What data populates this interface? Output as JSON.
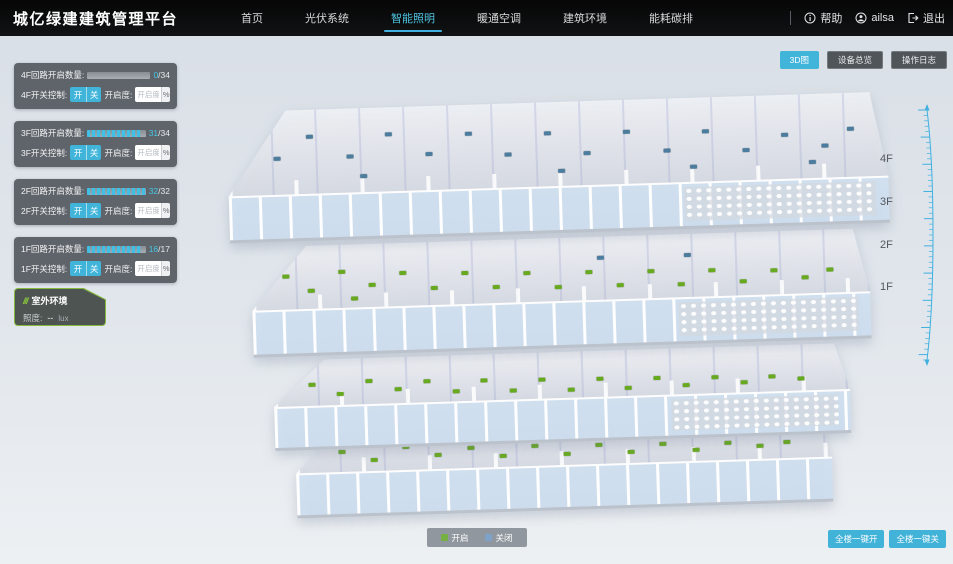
{
  "nav": {
    "title": "城亿绿建建筑管理平台",
    "items": [
      {
        "label": "首页"
      },
      {
        "label": "光伏系统"
      },
      {
        "label": "智能照明"
      },
      {
        "label": "暖通空调"
      },
      {
        "label": "建筑环境"
      },
      {
        "label": "能耗碳排"
      }
    ],
    "help": "帮助",
    "user": "ailsa",
    "logout": "退出"
  },
  "view_buttons": [
    {
      "label": "3D图"
    },
    {
      "label": "设备总览"
    },
    {
      "label": "操作日志"
    }
  ],
  "floor_panels": [
    {
      "count_label": "4F回路开启数量:",
      "open": 0,
      "total": 34,
      "value_open": "0",
      "value_rest": "/34",
      "switch_label": "4F开关控制:",
      "btn_on": "开",
      "btn_off": "关",
      "dim_label": "开启度:",
      "dim_placeholder": "开启度",
      "percent_label": "%"
    },
    {
      "count_label": "3F回路开启数量:",
      "open": 31,
      "total": 34,
      "value_open": "31",
      "value_rest": "/34",
      "switch_label": "3F开关控制:",
      "btn_on": "开",
      "btn_off": "关",
      "dim_label": "开启度:",
      "dim_placeholder": "开启度",
      "percent_label": "%"
    },
    {
      "count_label": "2F回路开启数量:",
      "open": 32,
      "total": 32,
      "value_open": "32",
      "value_rest": "/32",
      "switch_label": "2F开关控制:",
      "btn_on": "开",
      "btn_off": "关",
      "dim_label": "开启度:",
      "dim_placeholder": "开启度",
      "percent_label": "%"
    },
    {
      "count_label": "1F回路开启数量:",
      "open": 16,
      "total": 17,
      "value_open": "16",
      "value_rest": "/17",
      "switch_label": "1F开关控制:",
      "btn_on": "开",
      "btn_off": "关",
      "dim_label": "开启度:",
      "dim_placeholder": "开启度",
      "percent_label": "%"
    }
  ],
  "outdoor": {
    "title": "室外环境",
    "metric_label": "照度:",
    "metric_value": "--",
    "metric_unit": "lux"
  },
  "floor_labels": [
    "4F",
    "3F",
    "2F",
    "1F"
  ],
  "legend": {
    "on_label": "开启",
    "off_label": "关闭",
    "on_color": "#76b043",
    "off_color": "#7fa3c8"
  },
  "bulk_buttons": [
    {
      "label": "全楼一键开"
    },
    {
      "label": "全楼一键关"
    }
  ],
  "colors": {
    "accent": "#41b4da",
    "background": "#dde3e9",
    "panel": "#54595e",
    "dot_on": "#68aa1f",
    "dot_off": "#4d7d9e"
  },
  "building": {
    "floors": [
      {
        "id": "4F",
        "dots": [
          [
            7,
            55,
            0
          ],
          [
            12,
            30,
            0
          ],
          [
            18,
            55,
            0
          ],
          [
            24,
            30,
            0
          ],
          [
            30,
            55,
            0
          ],
          [
            36,
            32,
            0
          ],
          [
            42,
            58,
            0
          ],
          [
            48,
            34,
            0
          ],
          [
            54,
            60,
            0
          ],
          [
            60,
            36,
            0
          ],
          [
            66,
            60,
            0
          ],
          [
            72,
            38,
            0
          ],
          [
            78,
            62,
            0
          ],
          [
            84,
            45,
            0
          ],
          [
            90,
            60,
            0
          ],
          [
            94,
            40,
            0
          ],
          [
            20,
            78,
            0
          ],
          [
            50,
            80,
            0
          ],
          [
            70,
            80,
            0
          ],
          [
            88,
            78,
            0
          ]
        ]
      },
      {
        "id": "3F",
        "dots": [
          [
            5,
            45,
            1
          ],
          [
            9,
            68,
            1
          ],
          [
            14,
            40,
            1
          ],
          [
            19,
            62,
            1
          ],
          [
            24,
            45,
            1
          ],
          [
            29,
            70,
            1
          ],
          [
            34,
            48,
            1
          ],
          [
            39,
            72,
            1
          ],
          [
            44,
            50,
            1
          ],
          [
            49,
            74,
            1
          ],
          [
            54,
            52,
            1
          ],
          [
            59,
            75,
            1
          ],
          [
            64,
            54,
            1
          ],
          [
            69,
            76,
            1
          ],
          [
            74,
            56,
            1
          ],
          [
            79,
            74,
            1
          ],
          [
            84,
            58,
            1
          ],
          [
            89,
            72,
            1
          ],
          [
            93,
            60,
            1
          ],
          [
            16,
            82,
            1
          ],
          [
            56,
            30,
            0
          ],
          [
            70,
            30,
            0
          ]
        ]
      },
      {
        "id": "2F",
        "dots": [
          [
            6,
            50,
            1
          ],
          [
            11,
            72,
            1
          ],
          [
            16,
            45,
            1
          ],
          [
            21,
            66,
            1
          ],
          [
            26,
            50,
            1
          ],
          [
            31,
            74,
            1
          ],
          [
            36,
            52,
            1
          ],
          [
            41,
            76,
            1
          ],
          [
            46,
            54,
            1
          ],
          [
            51,
            78,
            1
          ],
          [
            56,
            56,
            1
          ],
          [
            61,
            78,
            1
          ],
          [
            66,
            58,
            1
          ],
          [
            71,
            76,
            1
          ],
          [
            76,
            60,
            1
          ],
          [
            81,
            74,
            1
          ],
          [
            86,
            62,
            1
          ],
          [
            91,
            70,
            1
          ]
        ]
      },
      {
        "id": "1F",
        "dots": [
          [
            8,
            50,
            1
          ],
          [
            14,
            70,
            1
          ],
          [
            20,
            45,
            1
          ],
          [
            26,
            65,
            1
          ],
          [
            32,
            50,
            1
          ],
          [
            38,
            70,
            1
          ],
          [
            44,
            52,
            1
          ],
          [
            50,
            72,
            1
          ],
          [
            56,
            54,
            1
          ],
          [
            62,
            72,
            1
          ],
          [
            68,
            56,
            1
          ],
          [
            74,
            70,
            1
          ],
          [
            80,
            58,
            1
          ],
          [
            86,
            66,
            1
          ],
          [
            91,
            60,
            1
          ],
          [
            58,
            36,
            0
          ]
        ]
      }
    ]
  }
}
